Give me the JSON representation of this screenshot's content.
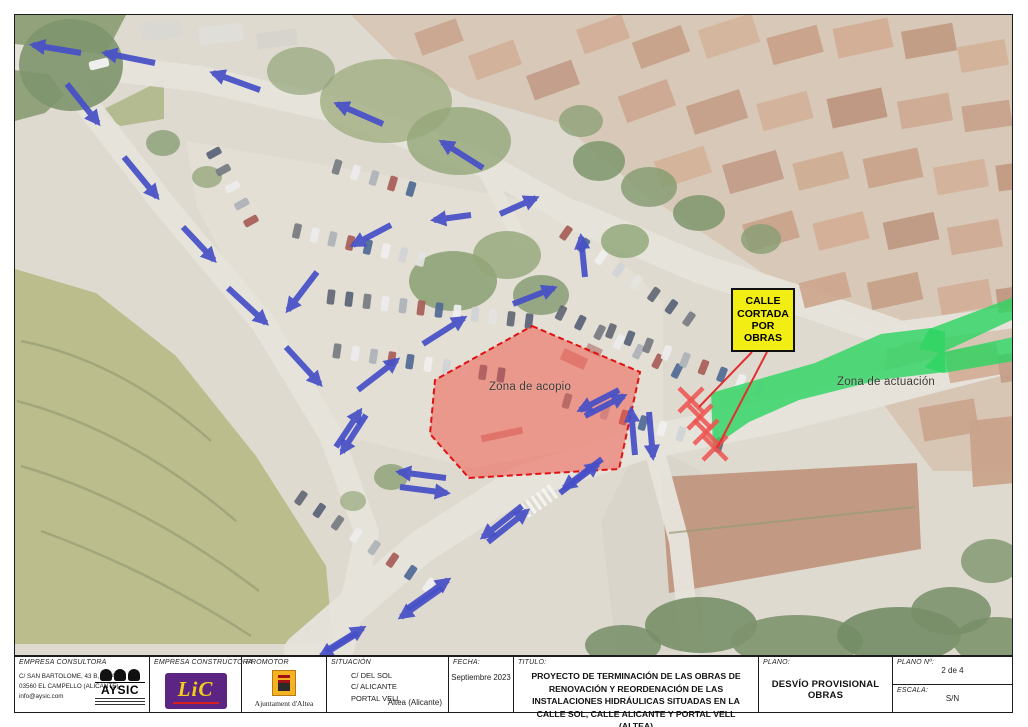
{
  "title_block": {
    "consultora": {
      "header": "EMPRESA CONSULTORA",
      "address_lines": [
        "C/ SAN BARTOLOME, 43 B, IZDA",
        "03560 EL CAMPELLO (ALICANTE)",
        "info@aysic.com"
      ],
      "logo_text": "AYSIC"
    },
    "constructora": {
      "header": "EMPRESA CONSTRUCTORA",
      "logo_text": "LiC"
    },
    "promotor": {
      "header": "PROMOTOR",
      "org": "Ajuntament d'Altea"
    },
    "situacion": {
      "header": "SITUACIÓN",
      "lines": [
        "C/ DEL SOL",
        "C/ ALICANTE",
        "PORTAL VELL"
      ],
      "municipio": "Altea (Alicante)"
    },
    "fecha": {
      "header": "FECHA:",
      "value": "Septiembre 2023"
    },
    "titulo": {
      "header": "TITULO:",
      "value": "PROYECTO DE TERMINACIÓN DE LAS OBRAS DE RENOVACIÓN Y REORDENACIÓN DE LAS INSTALACIONES HIDRÁULICAS SITUADAS EN LA CALLE SOL, CALLE ALICANTE Y PORTAL VELL (ALTEA)"
    },
    "plano": {
      "header": "PLANO:",
      "value": "DESVÍO PROVISIONAL OBRAS"
    },
    "plano_num": {
      "header": "PLANO Nº:",
      "value": "2 de 4"
    },
    "escala": {
      "header": "ESCALA:",
      "value": "S/N"
    }
  },
  "map": {
    "sign": {
      "text": "CALLE CORTADA POR OBRAS",
      "bg": "#f2ee14",
      "border": "#111111"
    },
    "zones": {
      "acopio": {
        "label": "Zona de acopio",
        "fill": "#f05548",
        "fill_opacity": 0.52,
        "stroke": "#e01313",
        "points": "531,325 639,371 618,468 468,477 429,433 434,379"
      },
      "actuacion": {
        "label": "Zona de actuación",
        "fill": "#2ed463",
        "fill_opacity": 0.82,
        "polygons": [
          "710,392 814,362 880,333 930,327 944,331 944,371 878,379 798,399 748,421 712,446",
          "928,328 1013,296 1013,318 940,352 918,348",
          "938,352 1013,336 1013,360 942,372 924,366"
        ]
      }
    },
    "arrow_color": "#4750c7",
    "arrows": [
      [
        80,
        52,
        32,
        44
      ],
      [
        154,
        62,
        104,
        52
      ],
      [
        259,
        89,
        212,
        72
      ],
      [
        382,
        123,
        336,
        103
      ],
      [
        482,
        167,
        441,
        141
      ],
      [
        66,
        83,
        97,
        122
      ],
      [
        123,
        156,
        156,
        196
      ],
      [
        182,
        226,
        213,
        259
      ],
      [
        227,
        287,
        265,
        322
      ],
      [
        285,
        346,
        319,
        383
      ],
      [
        390,
        224,
        352,
        244
      ],
      [
        316,
        271,
        287,
        309
      ],
      [
        470,
        214,
        433,
        219
      ],
      [
        499,
        213,
        535,
        197
      ],
      [
        584,
        276,
        580,
        236
      ],
      [
        512,
        303,
        553,
        287
      ],
      [
        422,
        343,
        463,
        317
      ],
      [
        357,
        389,
        396,
        359
      ],
      [
        335,
        446,
        359,
        410
      ],
      [
        365,
        414,
        341,
        451
      ],
      [
        445,
        477,
        398,
        471
      ],
      [
        399,
        486,
        446,
        492
      ],
      [
        559,
        492,
        597,
        463
      ],
      [
        601,
        458,
        563,
        487
      ],
      [
        584,
        415,
        623,
        395
      ],
      [
        618,
        389,
        579,
        409
      ],
      [
        634,
        454,
        630,
        409
      ],
      [
        648,
        411,
        652,
        456
      ],
      [
        487,
        541,
        526,
        510
      ],
      [
        521,
        505,
        482,
        536
      ],
      [
        406,
        608,
        447,
        579
      ],
      [
        441,
        587,
        400,
        616
      ],
      [
        325,
        650,
        362,
        627
      ],
      [
        357,
        632,
        320,
        655
      ]
    ],
    "closure_marks": {
      "color": "#ef5350",
      "size": 12,
      "centers": [
        [
          690,
          399
        ],
        [
          699,
          416
        ],
        [
          705,
          431
        ],
        [
          714,
          447
        ]
      ]
    },
    "sign_leaders": {
      "color": "#e03030",
      "lines": [
        [
          751,
          351,
          698,
          406
        ],
        [
          766,
          351,
          716,
          447
        ]
      ]
    }
  },
  "scenery": {
    "base": "#d8d1c5",
    "wash_opacity": 0.2,
    "regions": [
      {
        "name": "hillside",
        "pts": "14,268 95,292 175,355 255,455 325,565 332,643 14,643",
        "fill": "#a8ac6c",
        "op": 0.95
      },
      {
        "name": "trees-topleft",
        "pts": "14,14 125,14 102,58 44,112 14,120",
        "fill": "#6d854f",
        "op": 0.9
      },
      {
        "name": "village-ne",
        "pts": "560,14 1013,14 1013,330 888,332 762,272 642,192 560,122",
        "fill": "#cdb59c",
        "op": 0.8
      },
      {
        "name": "village-topcenter",
        "pts": "350,14 560,14 560,122 468,96 392,56",
        "fill": "#c9b29a",
        "op": 0.7
      },
      {
        "name": "village-e",
        "pts": "888,332 1013,330 1013,470 932,470 880,400",
        "fill": "#cbb298",
        "op": 0.8
      },
      {
        "name": "median-island",
        "pts": "95,112 163,78 163,118 120,125",
        "fill": "#9aa366",
        "op": 0.85
      },
      {
        "name": "parking-lot",
        "pts": "185,140 560,205 662,300 662,432 472,467 332,432 252,312 196,206",
        "fill": "#dcd7cb",
        "op": 1
      },
      {
        "name": "plaza-s",
        "pts": "640,440 700,470 700,650 615,650 600,520",
        "fill": "#d0cabd",
        "op": 0.9
      },
      {
        "name": "long-building",
        "pts": "660,476 916,462 920,548 668,592",
        "fill": "#b07a5c",
        "op": 0.92
      },
      {
        "name": "building-se",
        "pts": "968,420 1013,415 1013,482 972,486",
        "fill": "#bd8a6b",
        "op": 0.9
      }
    ],
    "roads": [
      {
        "d": "M14,56 L200,78 L340,110 L480,162 L575,215",
        "w": 26
      },
      {
        "d": "M60,70 L160,200 L262,322 L330,434 L366,532 L342,646",
        "w": 24
      },
      {
        "d": "M575,215 L700,268 L806,302 L892,332",
        "w": 30
      },
      {
        "d": "M300,650 L420,546 L520,482 L642,442 L780,414 L1013,354",
        "w": 34
      },
      {
        "d": "M480,162 L520,240",
        "w": 14
      },
      {
        "d": "M652,444 L678,540 L690,646",
        "w": 20
      },
      {
        "d": "M892,332 L1013,316",
        "w": 22
      }
    ],
    "road_color": "#e0dcd3",
    "terraces": [
      {
        "d": "M20,340 Q120,360 210,440",
        "w": 2.5
      },
      {
        "d": "M16,400 Q130,430 235,520",
        "w": 2.5
      },
      {
        "d": "M20,465 Q140,500 258,590",
        "w": 2.5
      },
      {
        "d": "M40,530 Q150,570 250,635",
        "w": 2.5
      },
      {
        "d": "M668,532 L914,506",
        "w": 2
      }
    ],
    "terrace_color": "#7e8352",
    "roofs": [
      [
        578,
        20,
        48,
        26,
        -20,
        "#c59a7d"
      ],
      [
        634,
        32,
        52,
        28,
        -20,
        "#b8896a"
      ],
      [
        700,
        20,
        56,
        30,
        -18,
        "#c9a183"
      ],
      [
        768,
        30,
        52,
        28,
        -15,
        "#ba8a6b"
      ],
      [
        834,
        22,
        56,
        30,
        -12,
        "#c59878"
      ],
      [
        902,
        26,
        52,
        28,
        -10,
        "#b08164"
      ],
      [
        958,
        42,
        48,
        26,
        -10,
        "#c99f80"
      ],
      [
        620,
        86,
        52,
        28,
        -20,
        "#c09073"
      ],
      [
        688,
        96,
        56,
        30,
        -18,
        "#b5856a"
      ],
      [
        758,
        96,
        52,
        28,
        -15,
        "#c79d7e"
      ],
      [
        828,
        92,
        56,
        30,
        -12,
        "#ab7a5e"
      ],
      [
        898,
        96,
        52,
        28,
        -10,
        "#c09578"
      ],
      [
        962,
        102,
        48,
        26,
        -8,
        "#b98a6d"
      ],
      [
        656,
        152,
        52,
        28,
        -18,
        "#c9a07f"
      ],
      [
        724,
        156,
        56,
        30,
        -16,
        "#b2826a"
      ],
      [
        794,
        156,
        52,
        28,
        -14,
        "#c39879"
      ],
      [
        864,
        152,
        56,
        30,
        -12,
        "#ba8c6e"
      ],
      [
        934,
        162,
        52,
        28,
        -10,
        "#c79d80"
      ],
      [
        996,
        162,
        38,
        26,
        -8,
        "#b07f62"
      ],
      [
        744,
        216,
        52,
        28,
        -16,
        "#bb8c6e"
      ],
      [
        814,
        216,
        52,
        28,
        -14,
        "#c79a7a"
      ],
      [
        884,
        216,
        52,
        28,
        -12,
        "#ad7c60"
      ],
      [
        948,
        222,
        52,
        28,
        -10,
        "#c39678"
      ],
      [
        800,
        276,
        48,
        26,
        -14,
        "#c08f70"
      ],
      [
        868,
        276,
        52,
        28,
        -12,
        "#b8876a"
      ],
      [
        938,
        282,
        52,
        28,
        -10,
        "#c79a7c"
      ],
      [
        996,
        286,
        34,
        24,
        -8,
        "#ae7d60"
      ],
      [
        946,
        346,
        52,
        32,
        -10,
        "#c59778"
      ],
      [
        998,
        352,
        30,
        28,
        -8,
        "#b58468"
      ],
      [
        920,
        402,
        56,
        34,
        -10,
        "#bd8d6f"
      ],
      [
        416,
        24,
        44,
        24,
        -20,
        "#bd8f72"
      ],
      [
        470,
        46,
        48,
        26,
        -20,
        "#c79c7e"
      ],
      [
        528,
        66,
        48,
        26,
        -20,
        "#b1836a"
      ],
      [
        140,
        20,
        40,
        18,
        -5,
        "#d0cec7"
      ],
      [
        198,
        24,
        44,
        18,
        -6,
        "#d9d6cf"
      ],
      [
        256,
        30,
        40,
        16,
        -8,
        "#cdc9c1"
      ]
    ],
    "trees": [
      [
        70,
        64,
        52,
        46,
        "#5e7a49",
        0.9
      ],
      [
        385,
        100,
        66,
        42,
        "#8a9b63",
        0.8
      ],
      [
        458,
        140,
        52,
        34,
        "#7b9158",
        0.8
      ],
      [
        300,
        70,
        34,
        24,
        "#79905a",
        0.7
      ],
      [
        452,
        280,
        44,
        30,
        "#6d8850",
        0.85
      ],
      [
        506,
        254,
        34,
        24,
        "#7a9158",
        0.8
      ],
      [
        540,
        294,
        28,
        20,
        "#647f4a",
        0.8
      ],
      [
        598,
        160,
        26,
        20,
        "#5f7c49",
        0.85
      ],
      [
        648,
        186,
        28,
        20,
        "#6a8651",
        0.85
      ],
      [
        698,
        212,
        26,
        18,
        "#5f7c49",
        0.85
      ],
      [
        624,
        240,
        24,
        17,
        "#729052",
        0.8
      ],
      [
        162,
        142,
        17,
        13,
        "#6b8752",
        0.8
      ],
      [
        206,
        176,
        15,
        11,
        "#72894f",
        0.7
      ],
      [
        390,
        476,
        17,
        13,
        "#6e8a52",
        0.8
      ],
      [
        352,
        500,
        13,
        10,
        "#7a9258",
        0.7
      ],
      [
        700,
        624,
        56,
        28,
        "#567343",
        0.9
      ],
      [
        796,
        640,
        66,
        26,
        "#5e7a49",
        0.9
      ],
      [
        898,
        634,
        62,
        28,
        "#51703f",
        0.9
      ],
      [
        996,
        640,
        44,
        24,
        "#5e7a49",
        0.9
      ],
      [
        622,
        644,
        38,
        20,
        "#567343",
        0.85
      ],
      [
        760,
        238,
        20,
        15,
        "#6a8651",
        0.8
      ],
      [
        580,
        120,
        22,
        16,
        "#6b8751",
        0.75
      ],
      [
        990,
        560,
        30,
        22,
        "#5e7a49",
        0.8
      ],
      [
        950,
        610,
        40,
        24,
        "#567343",
        0.85
      ]
    ],
    "car_rows": [
      [
        213,
        152,
        250,
        220,
        5
      ],
      [
        296,
        230,
        420,
        258,
        8
      ],
      [
        330,
        296,
        528,
        320,
        12
      ],
      [
        336,
        350,
        500,
        374,
        10
      ],
      [
        565,
        232,
        688,
        318,
        8
      ],
      [
        560,
        312,
        676,
        370,
        7
      ],
      [
        566,
        400,
        718,
        444,
        9
      ],
      [
        300,
        497,
        428,
        584,
        8
      ],
      [
        336,
        166,
        410,
        188,
        5
      ],
      [
        610,
        330,
        758,
        388,
        9
      ]
    ],
    "car_colors": [
      "#3c4250",
      "#ececec",
      "#99a0a8",
      "#2f3a55",
      "#c6c9cc",
      "#93342e",
      "#555b63",
      "#dcdcda",
      "#24437a",
      "#e8e8e8"
    ],
    "singles": [
      [
        98,
        63,
        -14,
        "#f2f2f2"
      ]
    ],
    "deco_marks": [
      [
        480,
        430,
        42,
        7,
        -12,
        "#b4352c",
        0.55
      ],
      [
        560,
        352,
        26,
        12,
        25,
        "#b4352c",
        0.5
      ],
      [
        585,
        345,
        16,
        8,
        25,
        "#8a2a22",
        0.5
      ]
    ],
    "zebra": {
      "cx": 538,
      "cy": 500,
      "angle": -35,
      "count": 6,
      "len": 16,
      "w": 3.5,
      "gap": 6.5,
      "color": "#f2f2ee"
    }
  }
}
